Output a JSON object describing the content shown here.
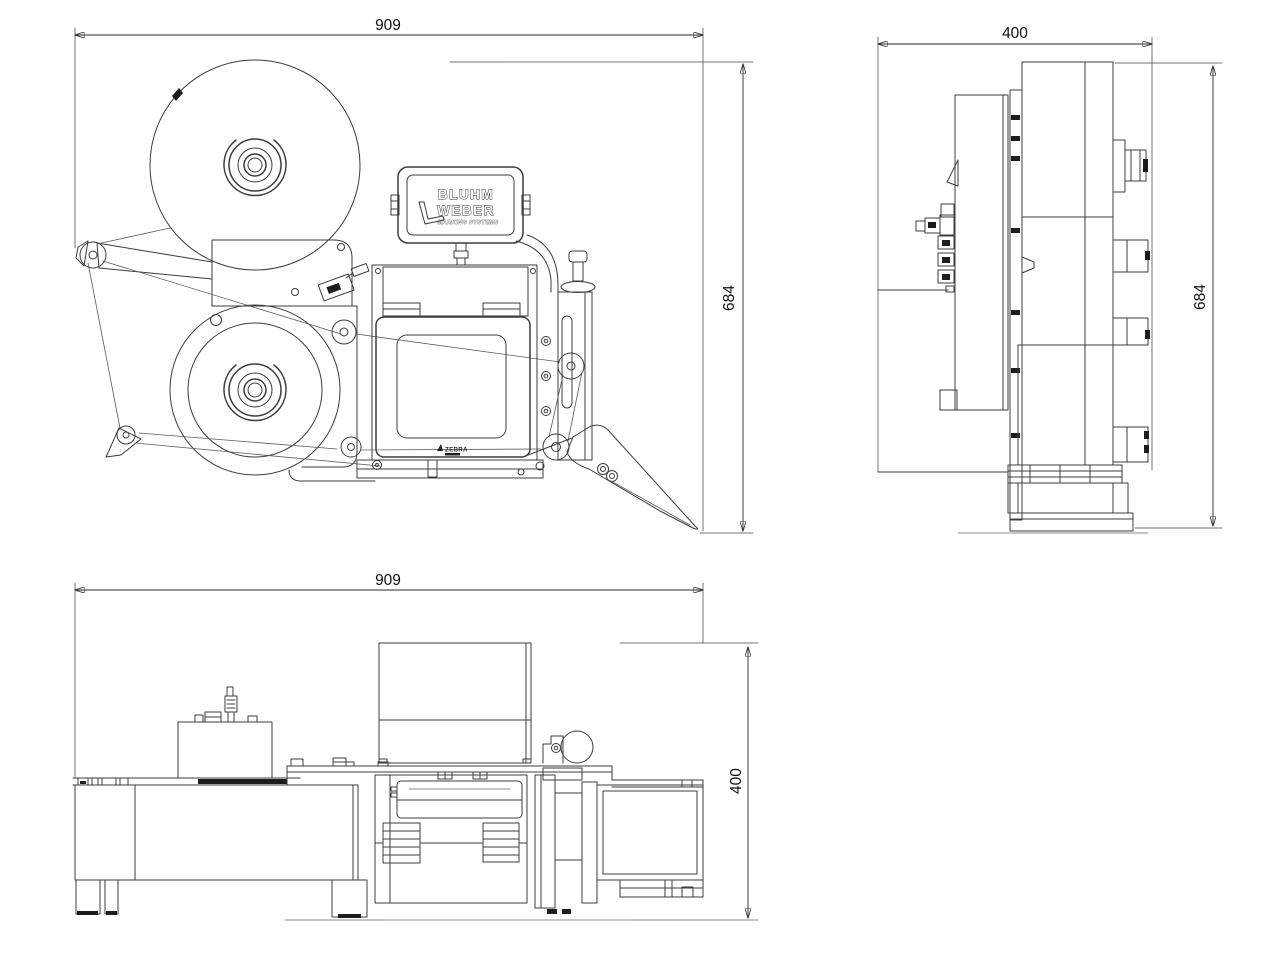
{
  "drawing": {
    "type": "technical-3-view-dimension-drawing",
    "subject": "label printer applicator",
    "colors": {
      "background": "#ffffff",
      "line": "#3c3c3c",
      "dimension": "#2a2a2a"
    },
    "dims": {
      "front_width": "909",
      "front_height": "684",
      "side_width": "400",
      "side_height": "684",
      "bottom_width": "909",
      "bottom_depth": "400"
    },
    "brand": {
      "line1": "BLUHM",
      "line2": "WEBER",
      "tagline": "MARKING SYSTEMS"
    },
    "printer": {
      "brand": "ZEBRA"
    }
  }
}
